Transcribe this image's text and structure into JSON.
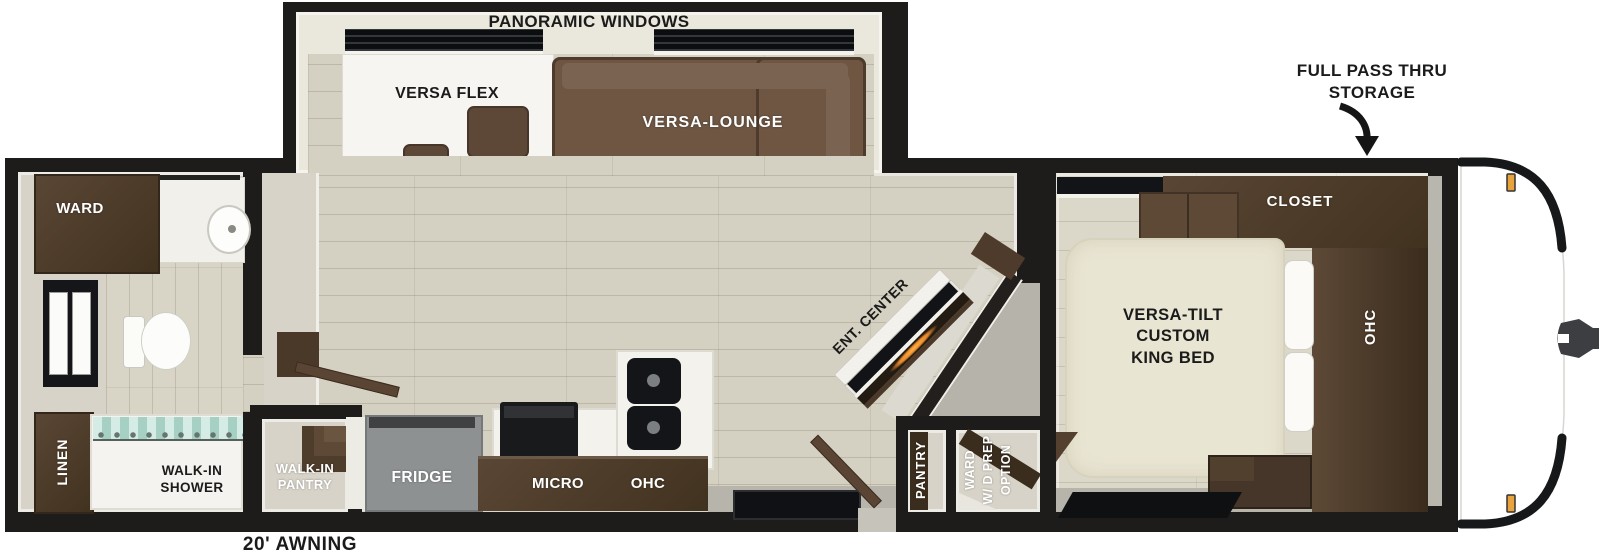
{
  "colors": {
    "wall": "#1d1c1a",
    "floor_wood": "#d5d1c2",
    "floor_wood_bedroom": "#dcd8c9",
    "wall_beige": "#d7d3c8",
    "cabinet_dark": "#4a3929",
    "sofa_brown": "#6e5643",
    "bed_cream": "#e9e5d3",
    "counter_white": "#f3f2ec",
    "fridge_gray": "#8e9192",
    "shower_curtain_teal": "#bfe0d8",
    "marker_light_amber": "#e8a33d",
    "entry_floor_gray": "#b7b4ac",
    "fireplace_glow": "#e8872a"
  },
  "slideout": {
    "panoramic_label": "PANORAMIC WINDOWS",
    "versa_flex": "VERSA FLEX",
    "versa_lounge": "VERSA-LOUNGE"
  },
  "front_storage": {
    "line1": "FULL PASS THRU",
    "line2": "STORAGE"
  },
  "bedroom": {
    "closet": "CLOSET",
    "ohc": "OHC",
    "bed": {
      "line1": "VERSA-TILT",
      "line2": "CUSTOM",
      "line3": "KING BED"
    }
  },
  "bathroom": {
    "ward": "WARD",
    "linen": "LINEN",
    "shower": {
      "line1": "WALK-IN",
      "line2": "SHOWER"
    }
  },
  "kitchen": {
    "fridge": "FRIDGE",
    "micro": "MICRO",
    "ohc": "OHC"
  },
  "storage_rooms": {
    "walk_in_pantry": {
      "line1": "WALK-IN",
      "line2": "PANTRY"
    },
    "pantry": "PANTRY",
    "ward_wd": {
      "line1": "WARD",
      "line2": "W/ D PREP",
      "line3": "OPTION"
    }
  },
  "living": {
    "ent_center": "ENT. CENTER"
  },
  "exterior": {
    "awning": "20' AWNING"
  }
}
